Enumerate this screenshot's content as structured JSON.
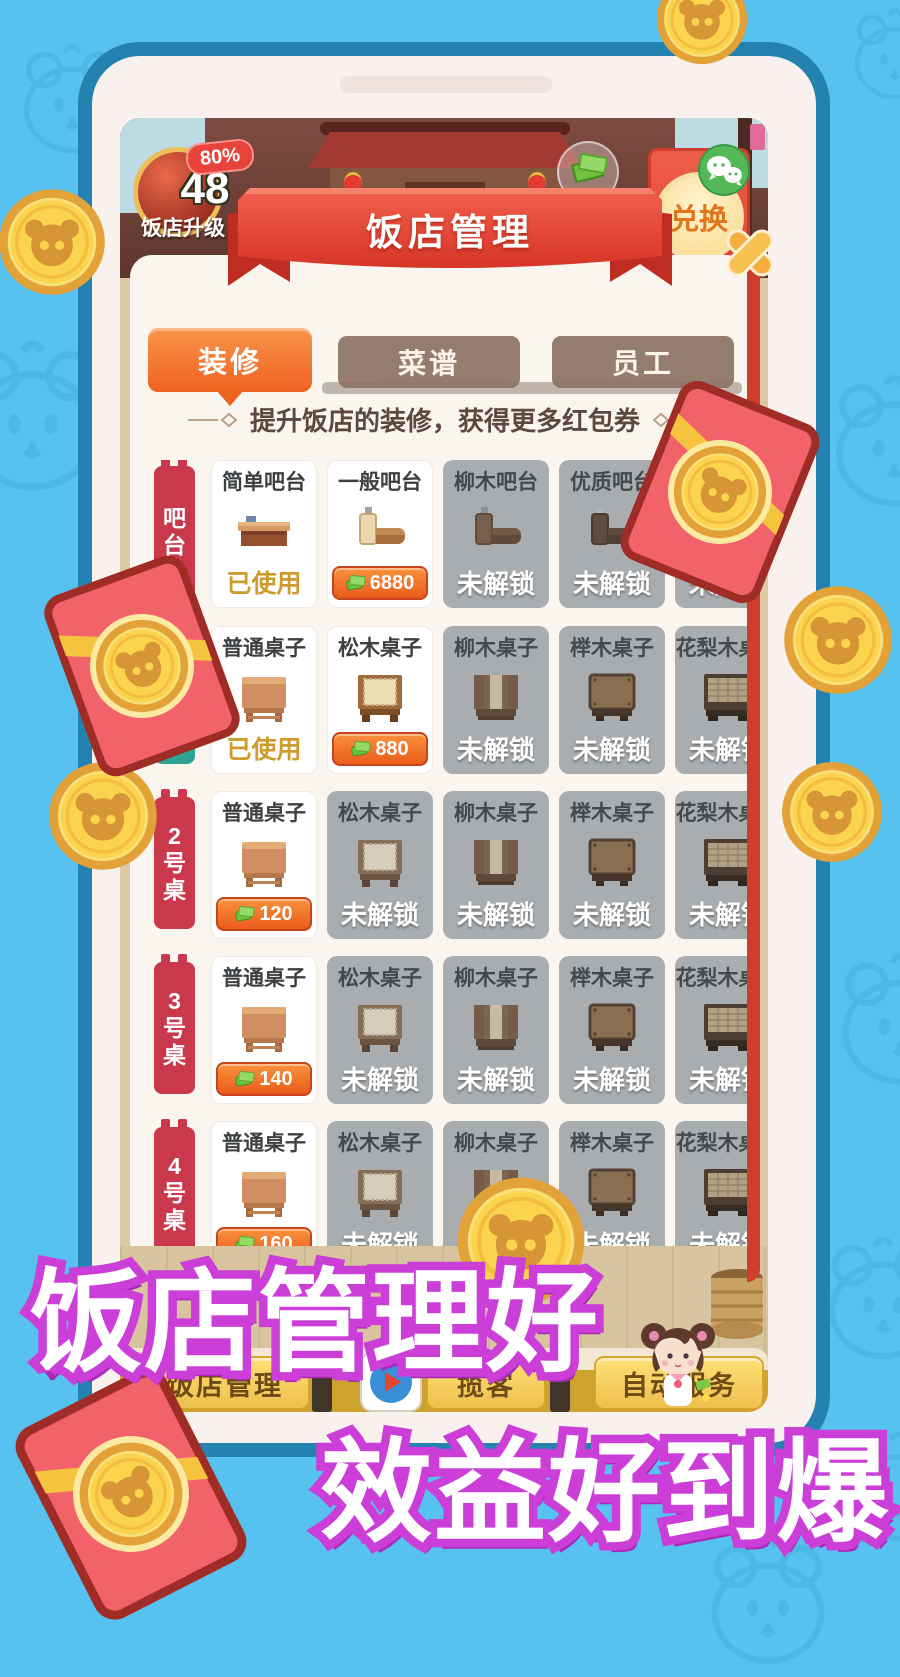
{
  "promo": {
    "line1": "饭店管理好",
    "line2": "效益好到爆"
  },
  "hud": {
    "progress": "80%",
    "level": "48",
    "level_label": "饭店升级",
    "exchange_label": "兑换"
  },
  "dialog": {
    "title": "饭店管理",
    "tabs": [
      {
        "label": "装修",
        "active": true
      },
      {
        "label": "菜谱",
        "active": false
      },
      {
        "label": "员工",
        "active": false
      }
    ],
    "subtitle": "提升饭店的装修，获得更多红包券",
    "used_label": "已使用",
    "locked_label": "未解锁",
    "rows": [
      {
        "label": "吧台",
        "label_color": "#c9394b",
        "items": [
          {
            "name": "简单吧台",
            "state": "used",
            "variant": "bar1"
          },
          {
            "name": "一般吧台",
            "state": "price",
            "price": "6880",
            "variant": "bar2"
          },
          {
            "name": "柳木吧台",
            "state": "locked",
            "variant": "bar3"
          },
          {
            "name": "优质吧台",
            "state": "locked",
            "variant": "bar4"
          },
          {
            "name": "",
            "state": "locked",
            "variant": "bar4"
          }
        ]
      },
      {
        "label": "1号桌",
        "label_color": "#2fa393",
        "items": [
          {
            "name": "普通桌子",
            "state": "used",
            "variant": "t1"
          },
          {
            "name": "松木桌子",
            "state": "price",
            "price": "880",
            "variant": "t2"
          },
          {
            "name": "柳木桌子",
            "state": "locked",
            "variant": "t3"
          },
          {
            "name": "榉木桌子",
            "state": "locked",
            "variant": "t4"
          },
          {
            "name": "花梨木桌子",
            "state": "locked",
            "variant": "t5"
          }
        ]
      },
      {
        "label": "2号桌",
        "label_color": "#c9394b",
        "items": [
          {
            "name": "普通桌子",
            "state": "price",
            "price": "120",
            "variant": "t1"
          },
          {
            "name": "松木桌子",
            "state": "locked",
            "variant": "t2"
          },
          {
            "name": "柳木桌子",
            "state": "locked",
            "variant": "t3"
          },
          {
            "name": "榉木桌子",
            "state": "locked",
            "variant": "t4"
          },
          {
            "name": "花梨木桌子",
            "state": "locked",
            "variant": "t5"
          }
        ]
      },
      {
        "label": "3号桌",
        "label_color": "#c9394b",
        "items": [
          {
            "name": "普通桌子",
            "state": "price",
            "price": "140",
            "variant": "t1"
          },
          {
            "name": "松木桌子",
            "state": "locked",
            "variant": "t2"
          },
          {
            "name": "柳木桌子",
            "state": "locked",
            "variant": "t3"
          },
          {
            "name": "榉木桌子",
            "state": "locked",
            "variant": "t4"
          },
          {
            "name": "花梨木桌子",
            "state": "locked",
            "variant": "t5"
          }
        ]
      },
      {
        "label": "4号桌",
        "label_color": "#c9394b",
        "items": [
          {
            "name": "普通桌子",
            "state": "price",
            "price": "160",
            "variant": "t1"
          },
          {
            "name": "松木桌子",
            "state": "locked",
            "variant": "t2"
          },
          {
            "name": "柳木桌子",
            "state": "locked",
            "variant": "t3"
          },
          {
            "name": "榉木桌子",
            "state": "locked",
            "variant": "t4"
          },
          {
            "name": "花梨木桌子",
            "state": "locked",
            "variant": "t5"
          }
        ]
      }
    ]
  },
  "bottom_bar": {
    "buttons": [
      "饭店管理",
      "揽客",
      "自动服务"
    ]
  },
  "icons": {
    "close": "cross",
    "play": "triangle",
    "wechat": "chat-bubbles",
    "money": "banknote",
    "coin": "bear-face-coin",
    "envelope": "red-envelope-with-coin"
  },
  "colors": {
    "bg_blue": "#57c1ef",
    "phone_border": "#2482b0",
    "accent_orange": "#ee6220",
    "ribbon_red": "#d63527",
    "dialog_frame_red": "#cf3e2c",
    "locked_gray": "#a9adb0",
    "label_red": "#c9394b",
    "label_teal": "#2fa393",
    "price_orange": "#ea5c1c",
    "used_gold": "#cf9a2e",
    "coin_gold": "#fbd44d",
    "envelope_red": "#f2626b",
    "promo_outline": "#cb3ed8"
  }
}
